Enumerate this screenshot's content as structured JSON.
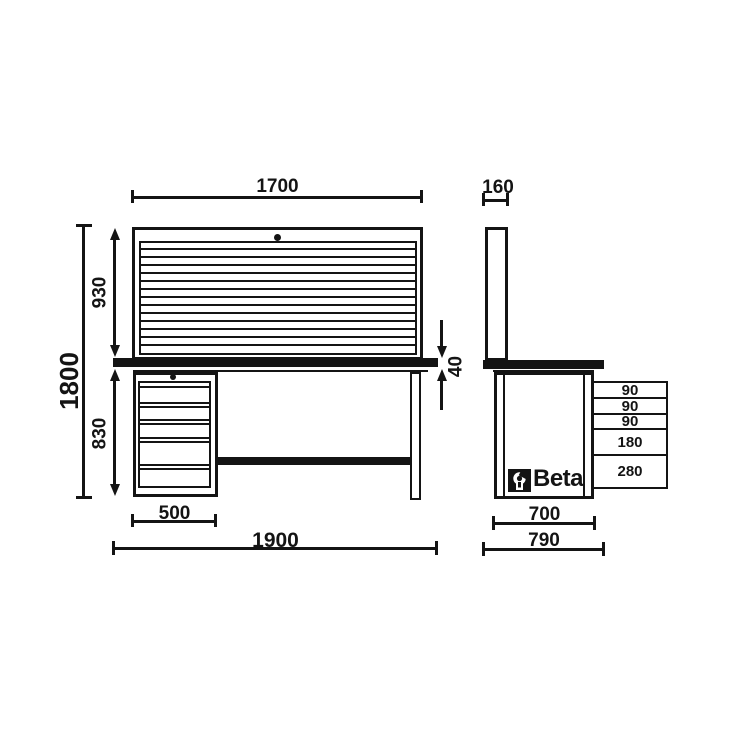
{
  "meta": {
    "drawing_type": "workbench dimensional drawing",
    "background_color": "#ffffff",
    "line_color": "#141414"
  },
  "brand": {
    "name": "Beta",
    "logo_icon": "wrench-icon"
  },
  "front_view": {
    "dim_top_width": "1700",
    "dim_panel_height": "930",
    "dim_total_height": "1800",
    "dim_lower_height": "830",
    "dim_worktop_thickness": "40",
    "dim_drawer_unit_width": "500",
    "dim_total_width": "1900"
  },
  "side_view": {
    "dim_panel_depth": "160",
    "drawer_heights": [
      "90",
      "90",
      "90",
      "180",
      "280"
    ],
    "dim_cabinet_depth": "700",
    "dim_total_depth": "790"
  }
}
